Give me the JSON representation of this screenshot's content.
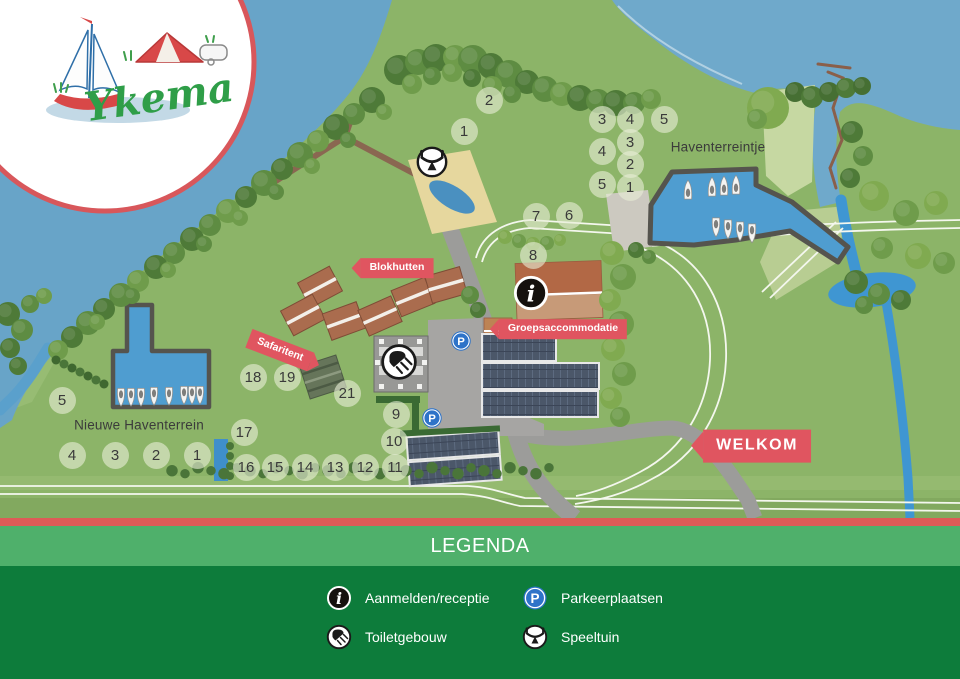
{
  "logo": {
    "name": "Ykema"
  },
  "map": {
    "area_labels": [
      {
        "id": "haventerreintje",
        "text": "Haventerreintje",
        "x": 718,
        "y": 147
      },
      {
        "id": "nieuwe-haventerrein",
        "text": "Nieuwe Haventerrein",
        "x": 139,
        "y": 425
      }
    ],
    "banners": [
      {
        "id": "blokhutten",
        "text": "Blokhutten",
        "x": 397,
        "y": 268,
        "arrow": "left",
        "rotate": 0,
        "large": false
      },
      {
        "id": "safaritent",
        "text": "Safaritent",
        "x": 280,
        "y": 350,
        "arrow": "right",
        "rotate": 21,
        "large": false
      },
      {
        "id": "groepsaccommodatie",
        "text": "Groepsaccommodatie",
        "x": 563,
        "y": 329,
        "arrow": "left",
        "rotate": 0,
        "large": false
      },
      {
        "id": "welkom",
        "text": "WELKOM",
        "x": 757,
        "y": 446,
        "arrow": "left",
        "rotate": 0,
        "large": true
      }
    ],
    "markers": [
      {
        "n": "2",
        "x": 489,
        "y": 100
      },
      {
        "n": "1",
        "x": 464,
        "y": 131
      },
      {
        "n": "3",
        "x": 602,
        "y": 119
      },
      {
        "n": "4",
        "x": 630,
        "y": 119
      },
      {
        "n": "5",
        "x": 664,
        "y": 119
      },
      {
        "n": "4",
        "x": 602,
        "y": 151
      },
      {
        "n": "3",
        "x": 630,
        "y": 142
      },
      {
        "n": "2",
        "x": 630,
        "y": 164
      },
      {
        "n": "5",
        "x": 602,
        "y": 184
      },
      {
        "n": "1",
        "x": 630,
        "y": 187
      },
      {
        "n": "7",
        "x": 536,
        "y": 216
      },
      {
        "n": "6",
        "x": 569,
        "y": 215
      },
      {
        "n": "8",
        "x": 533,
        "y": 255
      },
      {
        "n": "18",
        "x": 253,
        "y": 377
      },
      {
        "n": "19",
        "x": 287,
        "y": 377
      },
      {
        "n": "21",
        "x": 347,
        "y": 393
      },
      {
        "n": "17",
        "x": 244,
        "y": 432
      },
      {
        "n": "9",
        "x": 396,
        "y": 414
      },
      {
        "n": "10",
        "x": 394,
        "y": 441
      },
      {
        "n": "11",
        "x": 395,
        "y": 467
      },
      {
        "n": "12",
        "x": 365,
        "y": 467
      },
      {
        "n": "13",
        "x": 335,
        "y": 467
      },
      {
        "n": "14",
        "x": 305,
        "y": 467
      },
      {
        "n": "15",
        "x": 275,
        "y": 467
      },
      {
        "n": "16",
        "x": 246,
        "y": 467
      },
      {
        "n": "5",
        "x": 62,
        "y": 400
      },
      {
        "n": "4",
        "x": 72,
        "y": 455
      },
      {
        "n": "3",
        "x": 115,
        "y": 455
      },
      {
        "n": "2",
        "x": 156,
        "y": 455
      },
      {
        "n": "1",
        "x": 197,
        "y": 455
      }
    ],
    "icons": [
      {
        "type": "speeltuin",
        "x": 432,
        "y": 162,
        "size": 33
      },
      {
        "type": "receptie",
        "x": 531,
        "y": 293,
        "size": 37
      },
      {
        "type": "toilet",
        "x": 399,
        "y": 362,
        "size": 38
      },
      {
        "type": "parking",
        "x": 461,
        "y": 341,
        "size": 22
      },
      {
        "type": "parking",
        "x": 432,
        "y": 418,
        "size": 22
      }
    ]
  },
  "legend": {
    "title": "LEGENDA",
    "items": [
      {
        "icon": "receptie",
        "label": "Aanmelden/receptie"
      },
      {
        "icon": "parking",
        "label": "Parkeerplaatsen"
      },
      {
        "icon": "toilet",
        "label": "Toiletgebouw"
      },
      {
        "icon": "speeltuin",
        "label": "Speeltuin"
      }
    ]
  },
  "colors": {
    "banner_red": "#e05560",
    "stripe_red": "#de5b57",
    "legend_band_green": "#4fb06b",
    "legend_body_green": "#0d7c3b",
    "parking_blue": "#2e73c8",
    "logo_green": "#2f9e48",
    "lake_blue": "#68a4c8",
    "harbor_blue": "#4f9dd0",
    "grass_green": "#8cb468"
  }
}
